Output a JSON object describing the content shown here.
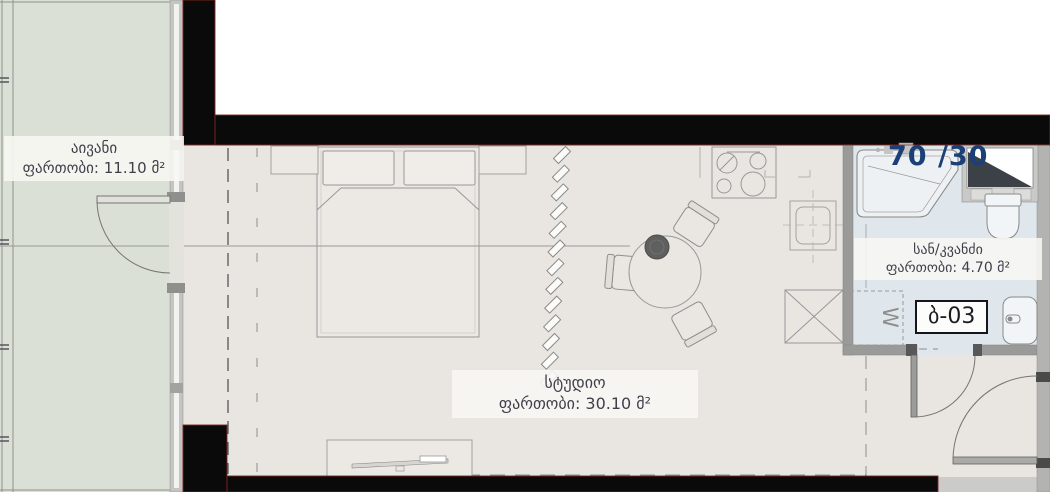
{
  "plan": {
    "ratio_label": "70 /30",
    "unit_number": "ბ-03",
    "washer_symbol": "W",
    "rooms": {
      "balcony": {
        "name": "აივანი",
        "area": "ფართობი: 11.10 მ²"
      },
      "studio": {
        "name": "სტუდიო",
        "area": "ფართობი: 30.10 მ²"
      },
      "bathroom": {
        "name": "სან/კვანძი",
        "area": "ფართობი: 4.70 მ²"
      }
    },
    "colors": {
      "accent_blue": "#1c3f77",
      "balcony_floor": "#dbe0d6",
      "studio_floor": "#e9e5e1",
      "bathroom_floor": "#dfe6ec",
      "wall_black": "#0a0a0a",
      "wall_gray": "#9a9a98",
      "wall_red_edge": "#7d241c"
    }
  }
}
